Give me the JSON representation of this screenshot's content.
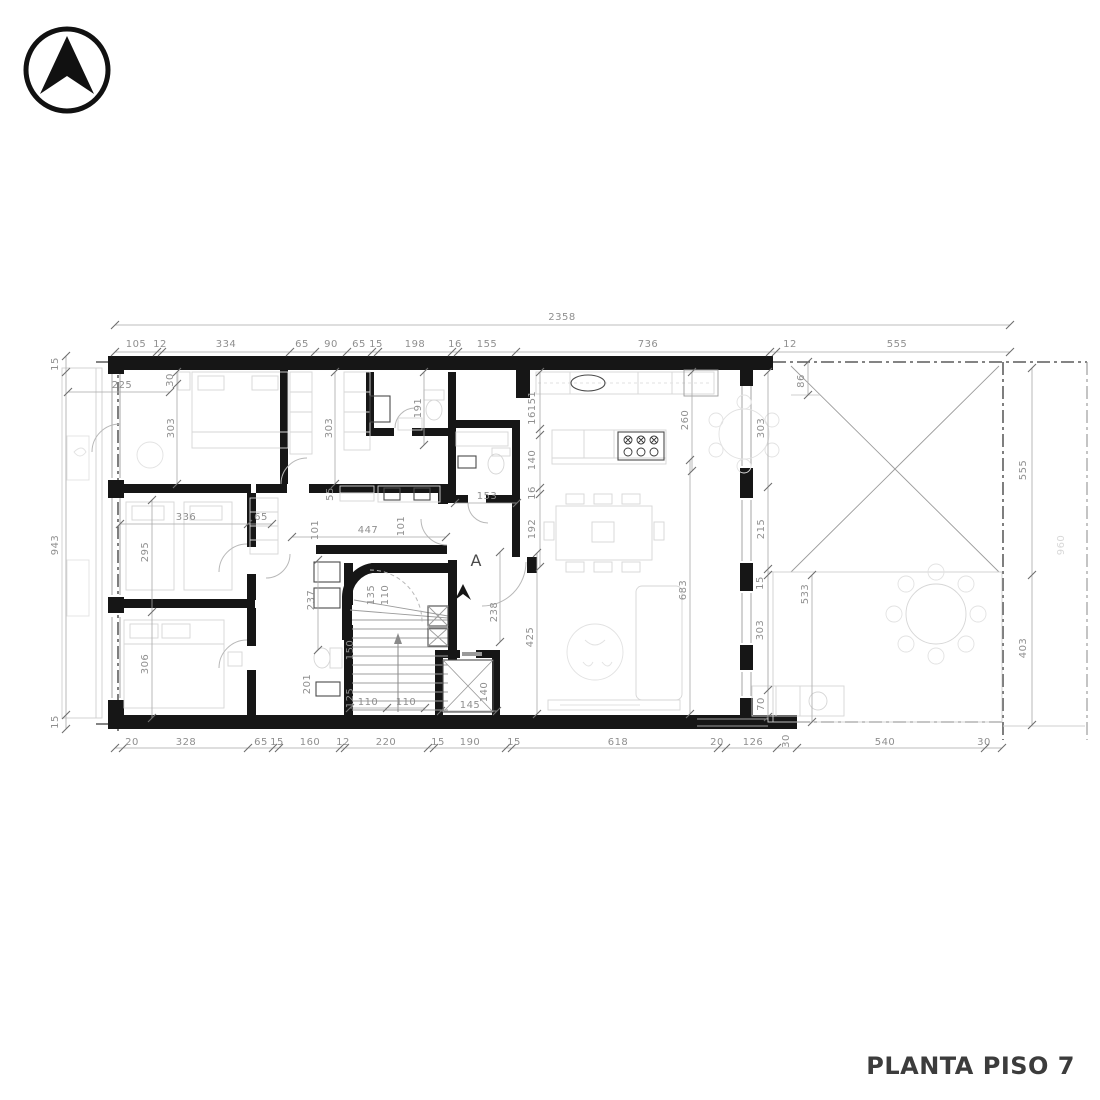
{
  "title": "PLANTA PISO 7",
  "compass": {
    "icon": "north-arrow"
  },
  "room_label_a": "A",
  "dims": {
    "overall_width": "2358",
    "top": [
      "105",
      "12",
      "334",
      "65",
      "90",
      "65",
      "15",
      "198",
      "16",
      "155",
      "736",
      "12",
      "555"
    ],
    "bottom": [
      "20",
      "328",
      "65",
      "15",
      "160",
      "12",
      "220",
      "15",
      "190",
      "15",
      "618",
      "20",
      "126",
      "30",
      "540",
      "30"
    ],
    "left": [
      "15",
      "943",
      "15"
    ],
    "right": [
      "555",
      "403"
    ],
    "interior": [
      "225",
      "30",
      "303",
      "303",
      "191",
      "55",
      "101",
      "447",
      "101",
      "336",
      "65",
      "295",
      "306",
      "237",
      "151",
      "16",
      "140",
      "16",
      "192",
      "153",
      "260",
      "303",
      "215",
      "15",
      "683",
      "86",
      "135",
      "110",
      "150",
      "201",
      "125",
      "110",
      "110",
      "145",
      "140",
      "238",
      "425",
      "303",
      "70",
      "533",
      "960"
    ]
  }
}
